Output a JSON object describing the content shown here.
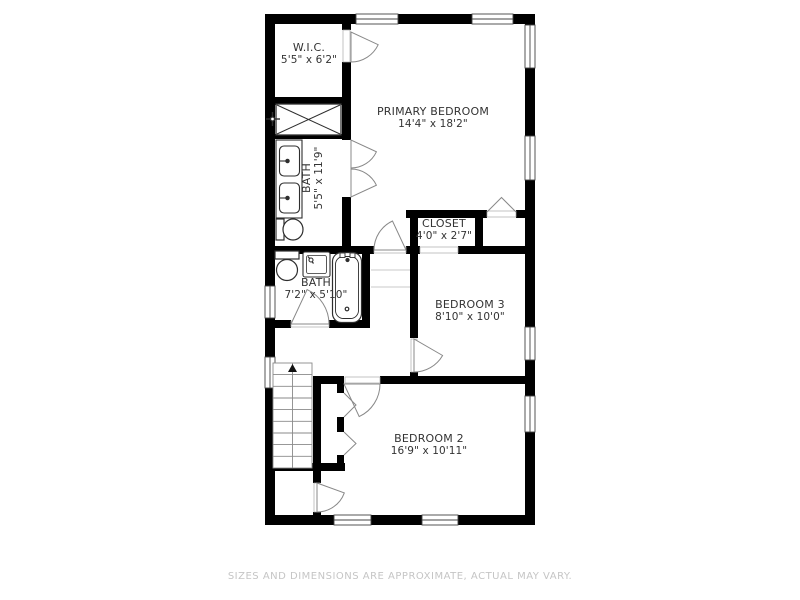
{
  "rooms": [
    {
      "name": "W.I.C.",
      "dims": "5'5\" x 6'2\""
    },
    {
      "name": "PRIMARY BEDROOM",
      "dims": "14'4\" x 18'2\""
    },
    {
      "name": "BATH",
      "dims": "5'5\" x 11'9\""
    },
    {
      "name": "CLOSET",
      "dims": "4'0\" x 2'7\""
    },
    {
      "name": "BATH",
      "dims": "7'2\" x 5'10\""
    },
    {
      "name": "BEDROOM 3",
      "dims": "8'10\" x 10'0\""
    },
    {
      "name": "BEDROOM 2",
      "dims": "16'9\" x 10'11\""
    }
  ],
  "stairs": {
    "direction": "up"
  },
  "footer": {
    "disclaimer": "SIZES AND DIMENSIONS ARE APPROXIMATE, ACTUAL MAY VARY."
  },
  "colors": {
    "background": "#ffffff",
    "wall": "#000000",
    "fixture_outline": "#2e2e2e",
    "door_stroke": "#888888",
    "label_text": "#333333",
    "footer_text": "#c5c5c5"
  }
}
